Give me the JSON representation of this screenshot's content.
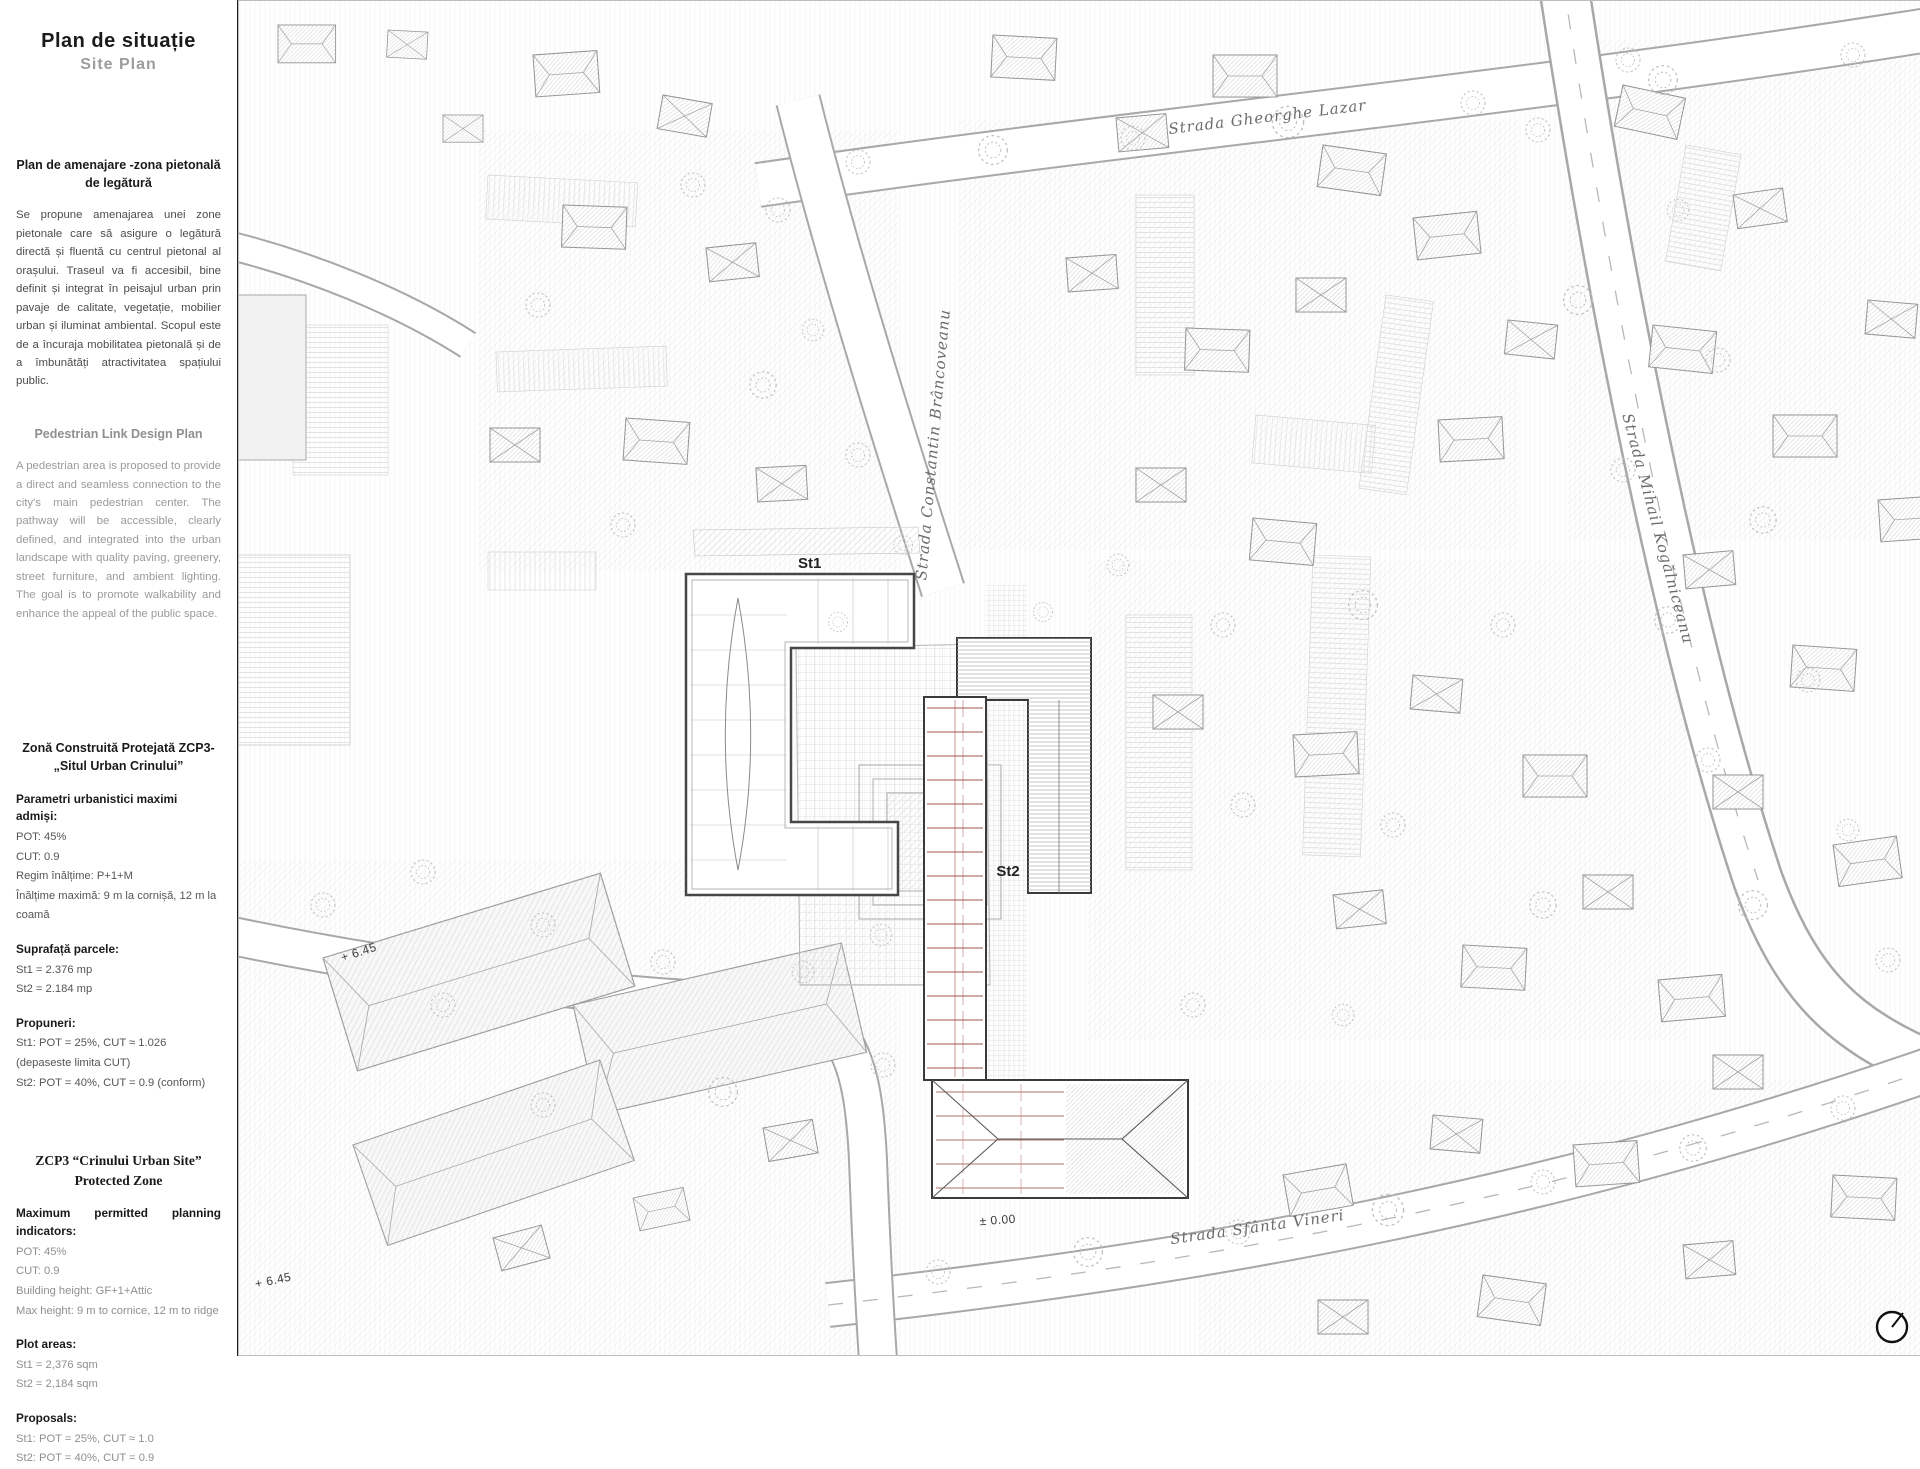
{
  "sheet": {
    "title_ro": "Plan de situație",
    "title_en": "Site Plan"
  },
  "sidebar": {
    "ro_plan": {
      "heading": "Plan de amenajare -zona pietonală de legătură",
      "body": "Se propune amenajarea unei zone pietonale care să asigure o legătură directă și fluentă cu centrul pietonal al orașului. Traseul va fi accesibil, bine definit și integrat în peisajul urban prin pavaje de calitate, vegetație, mobilier urban și iluminat ambiental. Scopul este de a încuraja mobilitatea pietonală și de a îmbunătăți atractivitatea spațiului public."
    },
    "en_plan": {
      "heading": "Pedestrian Link Design Plan",
      "body": "A pedestrian area is proposed to provide a direct and seamless connection to the city's main pedestrian center. The pathway will be accessible, clearly defined, and integrated into the urban landscape with quality paving, greenery, street furniture, and ambient lighting. The goal is to promote walkability and enhance the appeal of the public space."
    },
    "ro_zone": {
      "heading": "Zonă Construită Protejată ZCP3- „Situl Urban Crinului”",
      "params_label": "Parametri urbanistici maximi admiși:",
      "params": [
        "POT: 45%",
        "CUT: 0.9",
        "Regim înălțime: P+1+M",
        "Înălțime maximă: 9 m la cornișă, 12 m la coamă"
      ],
      "areas_label": "Suprafață parcele:",
      "areas": [
        "St1 = 2.376 mp",
        "St2 = 2.184 mp"
      ],
      "proposals_label": "Propuneri:",
      "proposals": [
        "St1: POT = 25%, CUT ≈ 1.026 (depaseste limita CUT)",
        "St2: POT = 40%, CUT = 0.9 (conform)"
      ]
    },
    "en_zone": {
      "heading": "ZCP3 “Crinului Urban Site” Protected Zone",
      "params_label": "Maximum permitted planning indicators:",
      "params": [
        "POT: 45%",
        "CUT: 0.9",
        "Building height: GF+1+Attic",
        "Max height: 9 m to cornice, 12 m to ridge"
      ],
      "areas_label": "Plot areas:",
      "areas": [
        "St1 = 2,376 sqm",
        "St2 = 2,184 sqm"
      ],
      "proposals_label": "Proposals:",
      "proposals": [
        "St1: POT = 25%, CUT ≈ 1.0",
        "St2: POT = 40%, CUT = 0.9"
      ]
    }
  },
  "map": {
    "streets": {
      "north": "Strada Gheorghe Lazar",
      "west": "Strada Constantin Brâncoveanu",
      "east": "Strada Mihail Kogălniceanu",
      "south": "Strada Sfânta Vineri"
    },
    "sites": {
      "st1": "St1",
      "st2": "St2"
    },
    "levels": {
      "plaza": "+ 6.45",
      "zero": "± 0.00",
      "southwest": "+ 6.45"
    }
  },
  "colors": {
    "accent_red": "#a3584a",
    "tree_pink": "#d4a7a4",
    "ink": "#1a1a1a"
  }
}
